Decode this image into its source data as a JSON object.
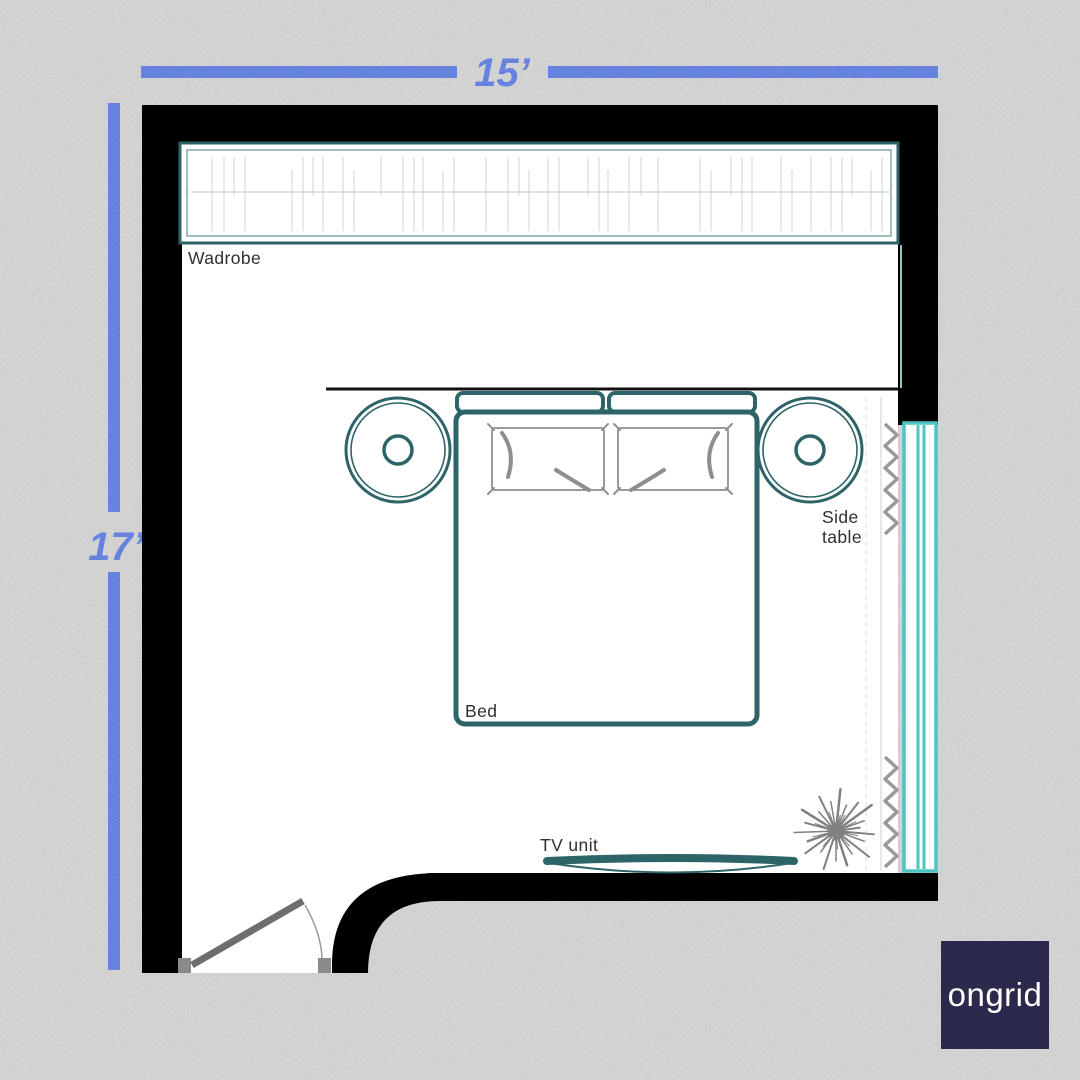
{
  "dimensions": {
    "top": "15’",
    "left": "17’"
  },
  "room": {
    "labels": {
      "wardrobe": "Wadrobe",
      "bed": "Bed",
      "side_table_line1": "Side",
      "side_table_line2": "table",
      "tv_unit": "TV unit"
    }
  },
  "logo": {
    "text": "ongrid"
  },
  "colors": {
    "dimension_blue": "#5074ea",
    "furniture_teal": "#2d6468",
    "window_teal": "#4cc5c5",
    "wall": "#000000",
    "floor": "#ffffff",
    "background": "#d8d8d8",
    "logo_navy": "#2b2a4c"
  }
}
